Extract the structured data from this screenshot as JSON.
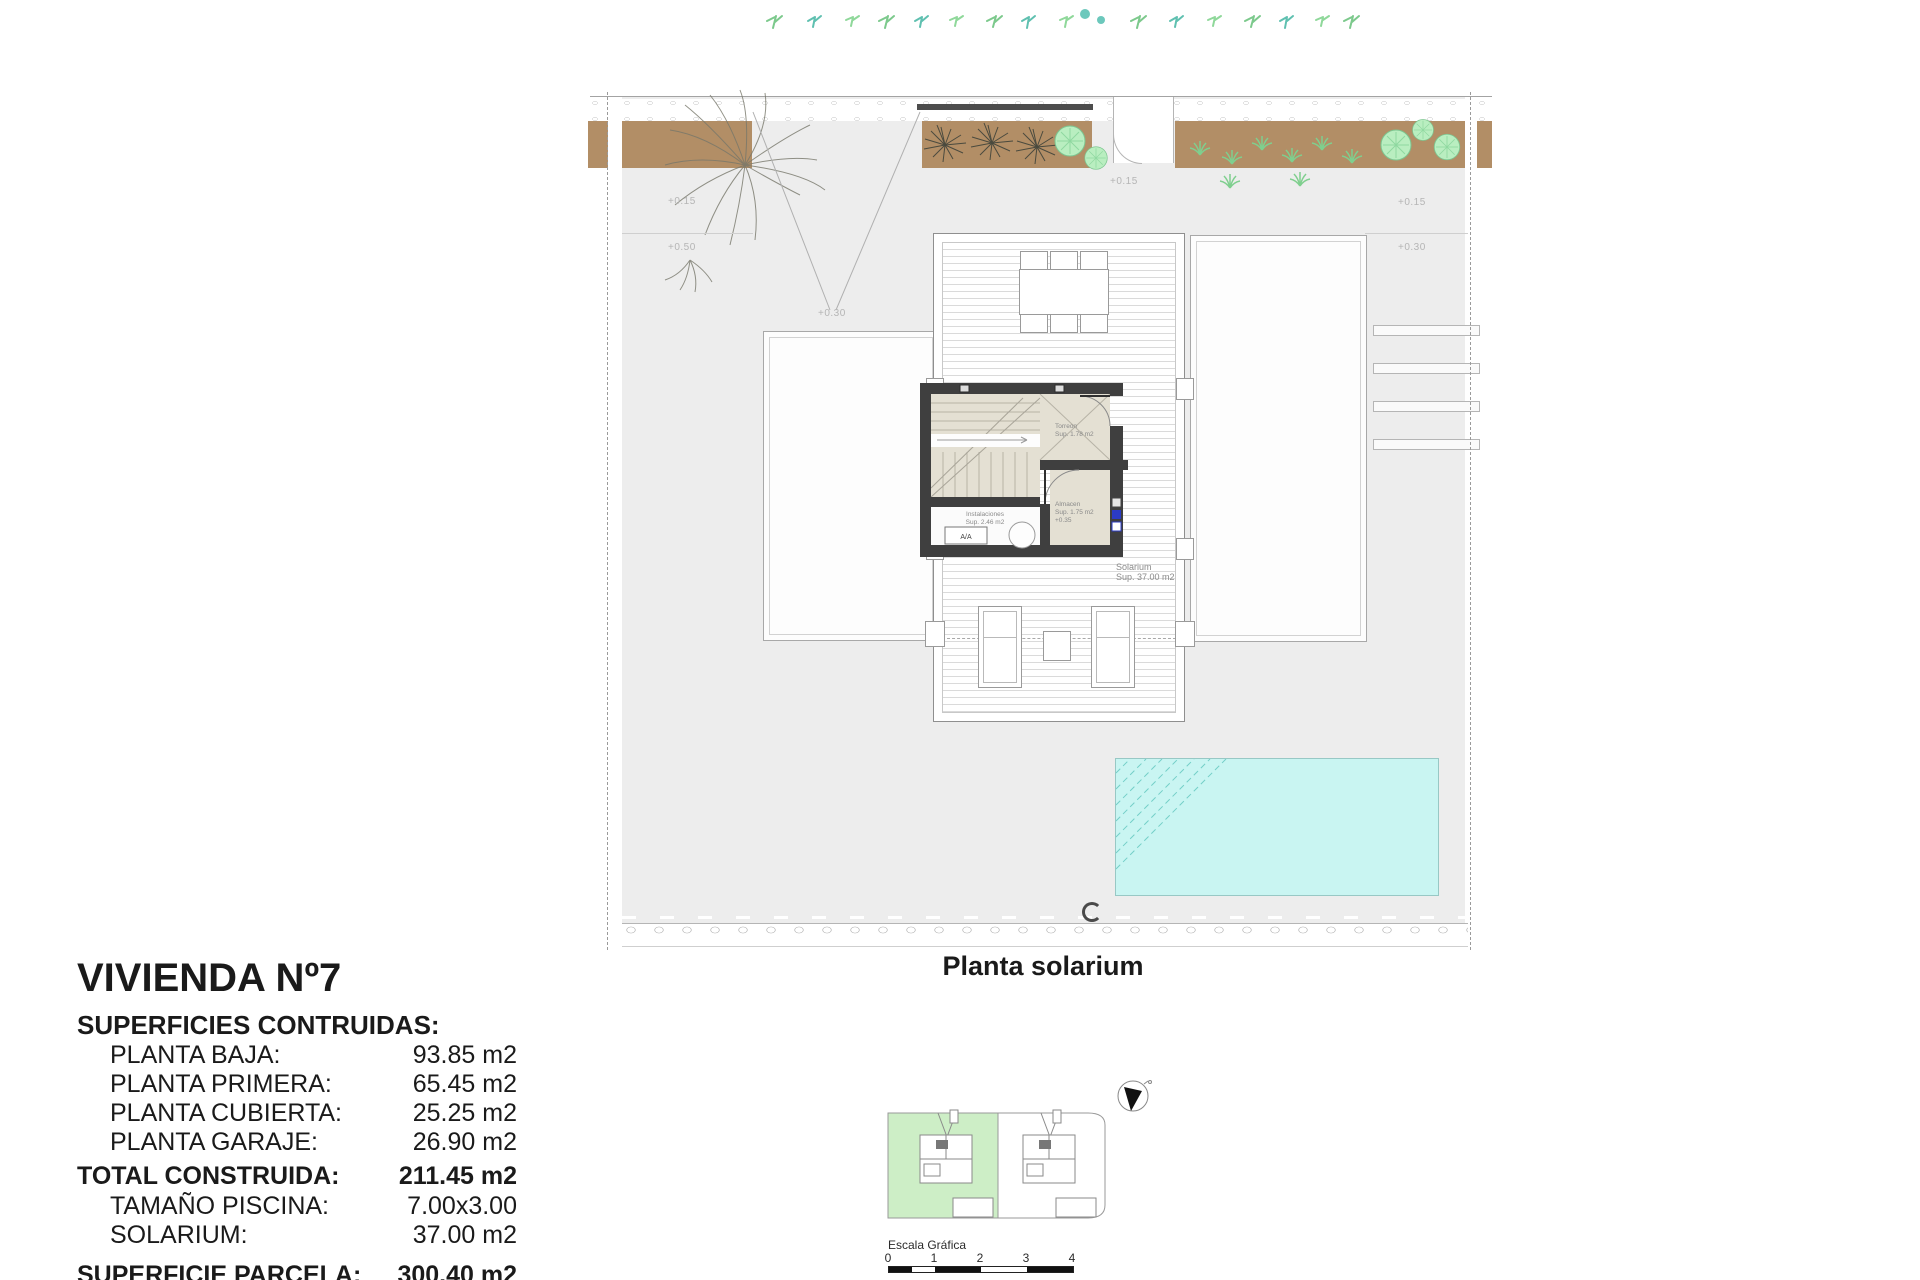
{
  "info": {
    "title": "VIVIENDA Nº7",
    "subtitle": "SUPERFICIES CONTRUIDAS:",
    "rows": [
      {
        "label": "PLANTA BAJA:",
        "value": "93.85 m2"
      },
      {
        "label": "PLANTA PRIMERA:",
        "value": "65.45 m2"
      },
      {
        "label": "PLANTA CUBIERTA:",
        "value": "25.25 m2"
      },
      {
        "label": "PLANTA GARAJE:",
        "value": "26.90 m2"
      },
      {
        "label": "TOTAL CONSTRUIDA:",
        "value": "211.45 m2"
      },
      {
        "label": "TAMAÑO PISCINA:",
        "value": "7.00x3.00"
      },
      {
        "label": "SOLARIUM:",
        "value": "37.00 m2"
      }
    ],
    "clipped_row": {
      "label": "SUPERFICIE PARCELA:",
      "value": "300.40 m2"
    }
  },
  "caption": "Planta solarium",
  "plan": {
    "rooms": {
      "torreon": {
        "name": "Torreon",
        "sup": "Sup. 1.78 m2"
      },
      "almacen": {
        "name": "Almacen",
        "sup": "Sup. 1.75 m2",
        "level": "+0.35"
      },
      "instalaciones": {
        "name": "Instalaciones",
        "sup": "Sup. 2.46 m2"
      },
      "solarium": {
        "name": "Solarium",
        "sup": "Sup. 37.00 m2"
      },
      "aa_unit": "A/A"
    },
    "levels": {
      "left_upper": "+0.15",
      "left_lower": "+0.50",
      "driveway": "+0.30",
      "entry": "+0.15",
      "right_upper": "+0.15",
      "right_lower": "+0.30"
    }
  },
  "scale_bar": {
    "label": "Escala Gráfica",
    "ticks": [
      "0",
      "1",
      "2",
      "3",
      "4"
    ]
  },
  "colors": {
    "pool": "#c9f5f2",
    "garden_soil": "#b28e66",
    "tree": "#b9eec0",
    "wall": "#3f3f3f",
    "stair_fill": "#e4e0d3",
    "keyplan_highlight": "#cdeec6",
    "vent_blue": "#2b3bc4",
    "plot_gray": "#ededed"
  }
}
